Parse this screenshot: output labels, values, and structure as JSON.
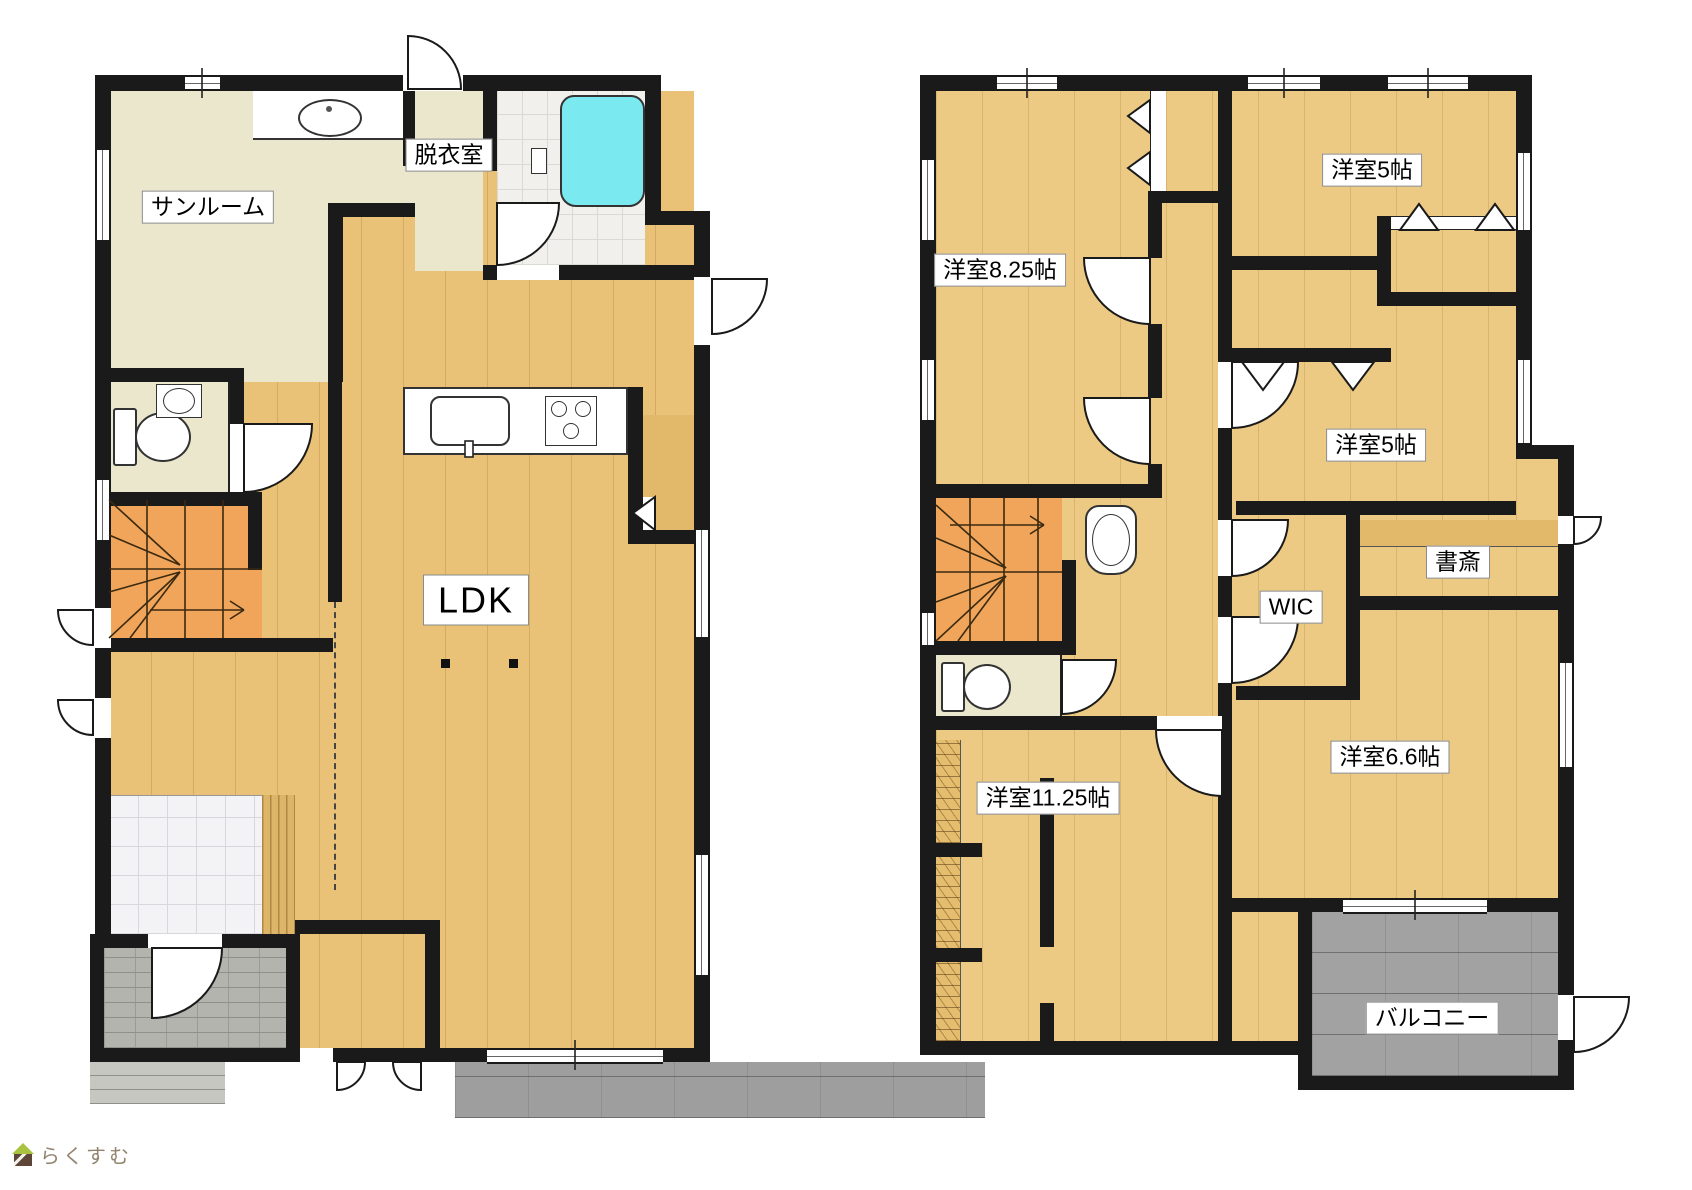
{
  "logo": {
    "text": "らくすむ"
  },
  "palette": {
    "wall": "#1a1a1a",
    "wood_floor": "#e9c177",
    "wood_floor_2f": "#ecca83",
    "pale_room": "#eae7cd",
    "stairs": "#f0a55b",
    "bathtub": "#7be9f0",
    "concrete": "#9e9e9e",
    "porch_brick": "#b3b4ad",
    "genkan_marble": "#f3f3f5",
    "bath_tile": "#f1f0ed",
    "deck": "#e2b96a"
  },
  "floor1": {
    "sunroom": "サンルーム",
    "dressing": "脱衣室",
    "ldk": "LDK"
  },
  "floor2": {
    "room825": "洋室8.25帖",
    "room5a": "洋室5帖",
    "room5b": "洋室5帖",
    "wic": "WIC",
    "study": "書斎",
    "room66": "洋室6.6帖",
    "room1125": "洋室11.25帖",
    "balcony": "バルコニー"
  }
}
